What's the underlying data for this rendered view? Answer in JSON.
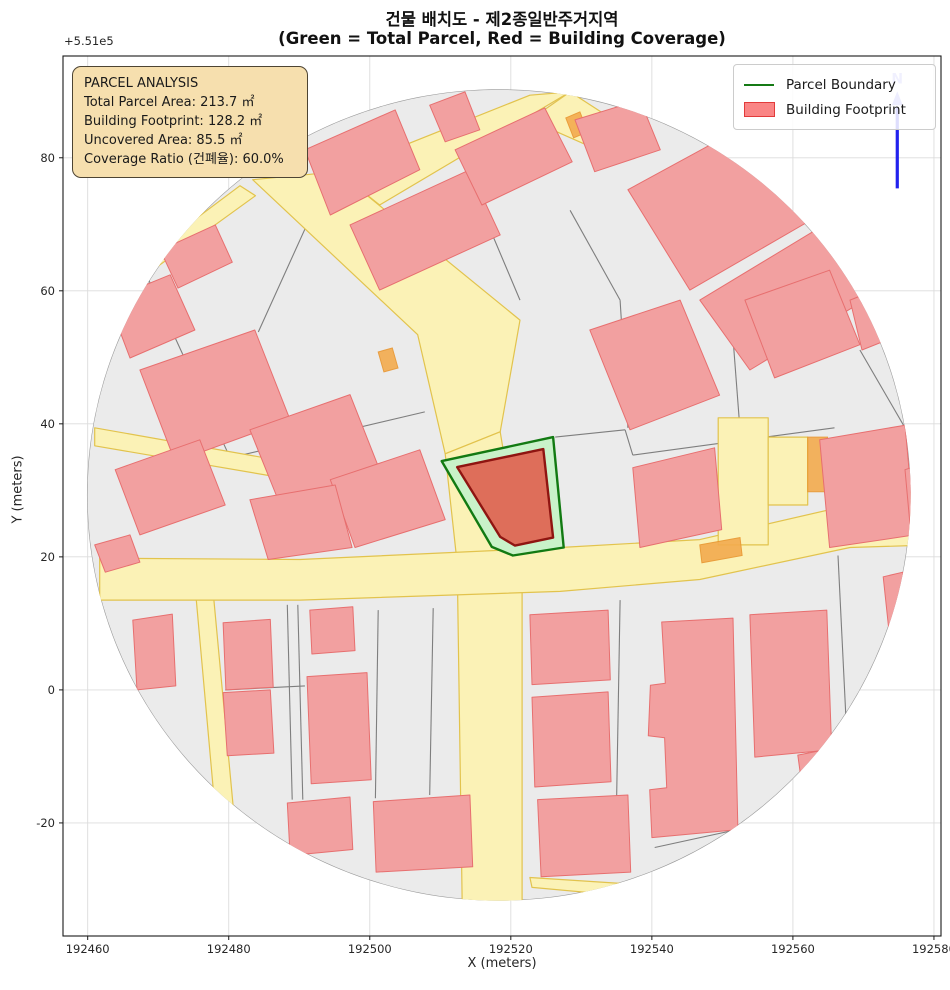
{
  "title": {
    "line1": "건물 배치도 - 제2종일반주거지역",
    "line2": "(Green = Total Parcel, Red = Building Coverage)"
  },
  "axes": {
    "x_label": "X (meters)",
    "y_label": "Y (meters)",
    "offset_text": "+5.51e5",
    "x_ticks": [
      192460,
      192480,
      192500,
      192520,
      192540,
      192560,
      192580
    ],
    "y_ticks": [
      -20,
      0,
      20,
      40,
      60,
      80
    ],
    "x_range": [
      192456.5,
      192581.0
    ],
    "y_range": [
      -37.0,
      95.3
    ],
    "grid": true,
    "grid_color": "#dcdcdc",
    "spine_color": "#1a1a1a",
    "tick_label_color": "#262626"
  },
  "legend": {
    "items": [
      {
        "label": "Parcel Boundary",
        "type": "line",
        "color": "#157a15"
      },
      {
        "label": "Building Footprint",
        "type": "patch",
        "fill": "#fa8585",
        "stroke": "#e23b3b"
      }
    ]
  },
  "annotation": {
    "title": "PARCEL ANALYSIS",
    "lines": [
      "Total Parcel Area: 213.7 ㎡",
      "Building Footprint: 128.2 ㎡",
      "Uncovered Area: 85.5 ㎡",
      "Coverage Ratio (건폐율): 60.0%"
    ],
    "bg": "#f6dfae",
    "border": "#4d4433"
  },
  "north_arrow": {
    "label": "N",
    "x": 192574.8,
    "y_base": 75.4,
    "y_head": 87.6,
    "y_tip": 90.0,
    "color": "#2222ee"
  },
  "chart_data": {
    "type": "map",
    "parcel_analysis": {
      "zoning": "제2종일반주거지역",
      "total_parcel_area_m2": 213.7,
      "building_footprint_m2": 128.2,
      "uncovered_area_m2": 85.5,
      "coverage_ratio_pct": 60.0
    },
    "colors": {
      "map_base": "#ebebeb",
      "map_edge": "#9a9a9a",
      "parcel_line": "#7e7e7e",
      "road_fill": "#fbf2b6",
      "road_edge": "#e2c34d",
      "orange_fill": "#f3ab4e",
      "orange_edge": "#e8952f",
      "building_fill": "#f2a0a0",
      "building_edge": "#e76f6f",
      "parcel_fill": "#c9f2c9",
      "parcel_edge": "#127a12",
      "footprint_fill": "#de6e5a",
      "footprint_edge": "#8f1511"
    },
    "map_extent": {
      "cx": 192518.3,
      "cy": 29.3,
      "rx": 58.4,
      "ry": 61.0
    },
    "highlight_parcel": [
      [
        192526.0,
        38.0
      ],
      [
        192510.2,
        34.4
      ],
      [
        192517.3,
        21.5
      ],
      [
        192520.3,
        20.2
      ],
      [
        192527.5,
        21.4
      ]
    ],
    "building_footprint": [
      [
        192512.4,
        33.5
      ],
      [
        192524.6,
        36.2
      ],
      [
        192526.0,
        22.9
      ],
      [
        192520.6,
        21.7
      ],
      [
        192518.5,
        23.0
      ]
    ],
    "roads": [
      [
        [
          192483.4,
          76.7
        ],
        [
          192495.5,
          77.9
        ],
        [
          192521.3,
          55.6
        ],
        [
          192518.5,
          38.8
        ],
        [
          192510.7,
          35.5
        ],
        [
          192506.8,
          53.4
        ]
      ],
      [
        [
          192510.7,
          35.5
        ],
        [
          192518.5,
          38.8
        ],
        [
          192521.6,
          19.0
        ],
        [
          192521.6,
          -32.3
        ],
        [
          192513.1,
          -32.3
        ],
        [
          192512.4,
          19.0
        ]
      ],
      [
        [
          192461.7,
          19.8
        ],
        [
          192490.1,
          19.6
        ],
        [
          192527.0,
          21.4
        ],
        [
          192546.8,
          22.6
        ],
        [
          192568.1,
          27.8
        ],
        [
          192576.9,
          29.8
        ],
        [
          192576.9,
          21.7
        ],
        [
          192568.1,
          21.4
        ],
        [
          192546.8,
          16.6
        ],
        [
          192527.0,
          14.8
        ],
        [
          192490.1,
          13.5
        ],
        [
          192461.7,
          13.5
        ]
      ],
      [
        [
          192475.4,
          13.5
        ],
        [
          192477.9,
          13.5
        ],
        [
          192481.6,
          -28.5
        ],
        [
          192479.0,
          -29.1
        ]
      ],
      [
        [
          192461.7,
          -27.6
        ],
        [
          192475.4,
          -29.4
        ],
        [
          192475.1,
          -30.9
        ],
        [
          192461.7,
          -29.1
        ]
      ],
      [
        [
          192522.7,
          -28.2
        ],
        [
          192535.8,
          -29.1
        ],
        [
          192535.5,
          -30.9
        ],
        [
          192523.0,
          -29.7
        ]
      ],
      [
        [
          192549.4,
          40.9
        ],
        [
          192556.5,
          40.9
        ],
        [
          192556.5,
          21.8
        ],
        [
          192549.4,
          21.8
        ]
      ],
      [
        [
          192556.5,
          38.0
        ],
        [
          192562.1,
          38.0
        ],
        [
          192562.1,
          27.8
        ],
        [
          192556.5,
          27.8
        ]
      ],
      [
        [
          192495.5,
          77.9
        ],
        [
          192522.7,
          89.4
        ],
        [
          192528.4,
          89.9
        ],
        [
          192501.4,
          72.9
        ]
      ],
      [
        [
          192528.4,
          89.9
        ],
        [
          192538.3,
          83.1
        ],
        [
          192535.5,
          79.7
        ],
        [
          192522.7,
          85.7
        ]
      ],
      [
        [
          192461.0,
          39.4
        ],
        [
          192508.5,
          30.5
        ],
        [
          192508.5,
          28.1
        ],
        [
          192461.0,
          36.7
        ]
      ],
      [
        [
          192481.6,
          75.8
        ],
        [
          192483.8,
          74.3
        ],
        [
          192468.8,
          62.8
        ],
        [
          192467.1,
          64.3
        ]
      ]
    ],
    "orange_patches": [
      [
        [
          192562.1,
          38.0
        ],
        [
          192564.9,
          38.0
        ],
        [
          192564.9,
          29.8
        ],
        [
          192562.1,
          29.8
        ]
      ],
      [
        [
          192527.8,
          86.0
        ],
        [
          192529.8,
          86.9
        ],
        [
          192530.9,
          83.9
        ],
        [
          192528.9,
          83.0
        ]
      ],
      [
        [
          192501.2,
          50.8
        ],
        [
          192503.2,
          51.4
        ],
        [
          192504.0,
          48.4
        ],
        [
          192502.0,
          47.8
        ]
      ],
      [
        [
          192546.8,
          21.8
        ],
        [
          192552.5,
          22.9
        ],
        [
          192552.8,
          20.2
        ],
        [
          192547.1,
          19.1
        ]
      ]
    ],
    "buildings": [
      [
        [
          192490.8,
          81.2
        ],
        [
          192503.6,
          87.2
        ],
        [
          192507.1,
          78.2
        ],
        [
          192494.4,
          71.4
        ]
      ],
      [
        [
          192497.2,
          69.9
        ],
        [
          192514.2,
          78.2
        ],
        [
          192518.5,
          68.4
        ],
        [
          192501.4,
          60.1
        ]
      ],
      [
        [
          192508.5,
          87.9
        ],
        [
          192513.5,
          89.9
        ],
        [
          192515.6,
          84.2
        ],
        [
          192510.7,
          82.4
        ]
      ],
      [
        [
          192512.1,
          81.2
        ],
        [
          192524.8,
          87.5
        ],
        [
          192528.7,
          79.4
        ],
        [
          192515.9,
          72.9
        ]
      ],
      [
        [
          192529.1,
          85.7
        ],
        [
          192538.3,
          88.7
        ],
        [
          192541.2,
          81.2
        ],
        [
          192531.9,
          77.9
        ]
      ],
      [
        [
          192536.6,
          75.2
        ],
        [
          192555.3,
          86.0
        ],
        [
          192563.8,
          71.4
        ],
        [
          192545.4,
          60.1
        ]
      ],
      [
        [
          192546.8,
          58.6
        ],
        [
          192563.8,
          69.5
        ],
        [
          192570.2,
          58.6
        ],
        [
          192553.9,
          48.1
        ]
      ],
      [
        [
          192568.1,
          58.6
        ],
        [
          192575.2,
          61.6
        ],
        [
          192576.9,
          54.1
        ],
        [
          192569.8,
          51.1
        ]
      ],
      [
        [
          192470.3,
          66.1
        ],
        [
          192478.1,
          69.9
        ],
        [
          192480.5,
          64.3
        ],
        [
          192472.8,
          60.4
        ]
      ],
      [
        [
          192462.9,
          58.6
        ],
        [
          192471.7,
          62.4
        ],
        [
          192475.2,
          54.1
        ],
        [
          192466.0,
          49.9
        ]
      ],
      [
        [
          192467.4,
          48.1
        ],
        [
          192483.7,
          54.1
        ],
        [
          192488.7,
          40.6
        ],
        [
          192472.4,
          34.3
        ]
      ],
      [
        [
          192463.9,
          33.1
        ],
        [
          192475.9,
          37.6
        ],
        [
          192479.5,
          27.8
        ],
        [
          192467.4,
          23.3
        ]
      ],
      [
        [
          192483.0,
          39.1
        ],
        [
          192497.2,
          44.4
        ],
        [
          192501.4,
          33.1
        ],
        [
          192487.3,
          27.8
        ]
      ],
      [
        [
          192494.4,
          31.6
        ],
        [
          192507.1,
          36.1
        ],
        [
          192510.7,
          25.6
        ],
        [
          192497.9,
          21.4
        ]
      ],
      [
        [
          192461.0,
          21.8
        ],
        [
          192466.0,
          23.3
        ],
        [
          192467.4,
          19.2
        ],
        [
          192462.5,
          17.7
        ]
      ],
      [
        [
          192483.0,
          28.6
        ],
        [
          192495.1,
          30.8
        ],
        [
          192497.5,
          21.4
        ],
        [
          192485.6,
          19.6
        ]
      ],
      [
        [
          192491.5,
          12.0
        ],
        [
          192497.6,
          12.5
        ],
        [
          192497.9,
          5.9
        ],
        [
          192491.8,
          5.4
        ]
      ],
      [
        [
          192479.2,
          10.1
        ],
        [
          192485.9,
          10.6
        ],
        [
          192486.3,
          0.4
        ],
        [
          192479.6,
          0.0
        ]
      ],
      [
        [
          192479.2,
          -0.4
        ],
        [
          192485.9,
          0.0
        ],
        [
          192486.4,
          -9.5
        ],
        [
          192479.8,
          -9.9
        ]
      ],
      [
        [
          192491.1,
          2.0
        ],
        [
          192499.6,
          2.6
        ],
        [
          192500.2,
          -13.5
        ],
        [
          192491.7,
          -14.1
        ]
      ],
      [
        [
          192488.3,
          -17.0
        ],
        [
          192497.2,
          -16.1
        ],
        [
          192497.6,
          -24.0
        ],
        [
          192488.7,
          -24.9
        ]
      ],
      [
        [
          192500.5,
          -16.8
        ],
        [
          192514.2,
          -15.8
        ],
        [
          192514.6,
          -26.6
        ],
        [
          192500.9,
          -27.4
        ]
      ],
      [
        [
          192466.4,
          10.5
        ],
        [
          192472.0,
          11.4
        ],
        [
          192472.5,
          0.6
        ],
        [
          192467.0,
          0.0
        ]
      ],
      [
        [
          192522.7,
          11.3
        ],
        [
          192533.8,
          12.0
        ],
        [
          192534.1,
          1.5
        ],
        [
          192523.0,
          0.8
        ]
      ],
      [
        [
          192523.0,
          -1.1
        ],
        [
          192533.8,
          -0.3
        ],
        [
          192534.2,
          -13.8
        ],
        [
          192523.4,
          -14.6
        ]
      ],
      [
        [
          192523.8,
          -16.5
        ],
        [
          192536.6,
          -15.8
        ],
        [
          192537.0,
          -27.4
        ],
        [
          192524.3,
          -28.1
        ]
      ],
      [
        [
          192541.4,
          10.2
        ],
        [
          192551.5,
          10.8
        ],
        [
          192552.2,
          -21.0
        ],
        [
          192540.0,
          -22.2
        ],
        [
          192539.7,
          -15.0
        ],
        [
          192542.1,
          -14.7
        ],
        [
          192541.8,
          -7.2
        ],
        [
          192539.5,
          -6.9
        ],
        [
          192539.8,
          0.7
        ],
        [
          192541.9,
          1.0
        ]
      ],
      [
        [
          192553.9,
          11.3
        ],
        [
          192564.8,
          12.0
        ],
        [
          192565.5,
          -9.0
        ],
        [
          192554.6,
          -10.1
        ]
      ],
      [
        [
          192560.7,
          -9.8
        ],
        [
          192566.4,
          -8.6
        ],
        [
          192567.4,
          -16.5
        ],
        [
          192561.7,
          -17.6
        ]
      ],
      [
        [
          192572.8,
          17.0
        ],
        [
          192575.6,
          17.7
        ],
        [
          192576.6,
          9.0
        ],
        [
          192573.7,
          8.1
        ]
      ],
      [
        [
          192537.3,
          33.4
        ],
        [
          192548.9,
          36.4
        ],
        [
          192549.9,
          24.1
        ],
        [
          192538.3,
          21.4
        ]
      ],
      [
        [
          192563.8,
          37.6
        ],
        [
          192575.9,
          39.8
        ],
        [
          192577.3,
          23.3
        ],
        [
          192565.2,
          21.4
        ]
      ],
      [
        [
          192531.2,
          54.1
        ],
        [
          192544.0,
          58.6
        ],
        [
          192549.6,
          44.3
        ],
        [
          192536.9,
          39.1
        ]
      ],
      [
        [
          192553.2,
          58.6
        ],
        [
          192565.2,
          63.1
        ],
        [
          192569.5,
          51.9
        ],
        [
          192557.4,
          46.9
        ]
      ],
      [
        [
          192575.9,
          33.1
        ],
        [
          192579.4,
          34.3
        ],
        [
          192580.3,
          22.6
        ],
        [
          192576.9,
          21.4
        ]
      ],
      [
        [
          192575.6,
          49.6
        ],
        [
          192579.1,
          50.8
        ],
        [
          192580.0,
          40.6
        ],
        [
          192576.3,
          39.4
        ]
      ]
    ],
    "parcel_lines": [
      [
        [
          192467.8,
          63.6
        ],
        [
          192480.2,
          34.9
        ]
      ],
      [
        [
          192480.2,
          34.9
        ],
        [
          192507.8,
          41.8
        ]
      ],
      [
        [
          192491.5,
          70.9
        ],
        [
          192484.2,
          53.8
        ]
      ],
      [
        [
          192515.6,
          72.9
        ],
        [
          192521.3,
          58.6
        ]
      ],
      [
        [
          192526.3,
          38.0
        ],
        [
          192536.2,
          39.1
        ]
      ],
      [
        [
          192536.2,
          39.1
        ],
        [
          192537.3,
          35.3
        ]
      ],
      [
        [
          192537.3,
          35.3
        ],
        [
          192565.9,
          39.4
        ]
      ],
      [
        [
          192552.5,
          39.1
        ],
        [
          192551.1,
          58.6
        ]
      ],
      [
        [
          192535.5,
          58.6
        ],
        [
          192536.6,
          39.4
        ]
      ],
      [
        [
          192570.2,
          58.6
        ],
        [
          192576.9,
          54.1
        ]
      ],
      [
        [
          192569.5,
          51.1
        ],
        [
          192575.9,
          39.4
        ]
      ],
      [
        [
          192488.3,
          12.8
        ],
        [
          192489.0,
          -16.5
        ]
      ],
      [
        [
          192489.8,
          12.8
        ],
        [
          192490.5,
          -16.5
        ]
      ],
      [
        [
          192479.5,
          0.0
        ],
        [
          192490.8,
          0.6
        ]
      ],
      [
        [
          192535.5,
          13.5
        ],
        [
          192534.9,
          -22.5
        ]
      ],
      [
        [
          192566.4,
          20.2
        ],
        [
          192567.8,
          -10.3
        ]
      ],
      [
        [
          192540.4,
          -23.7
        ],
        [
          192566.4,
          -17.7
        ]
      ],
      [
        [
          192501.2,
          12.0
        ],
        [
          192500.8,
          -16.3
        ]
      ],
      [
        [
          192509.0,
          12.3
        ],
        [
          192508.5,
          -15.8
        ]
      ],
      [
        [
          192528.4,
          72.1
        ],
        [
          192535.5,
          58.6
        ]
      ]
    ]
  }
}
